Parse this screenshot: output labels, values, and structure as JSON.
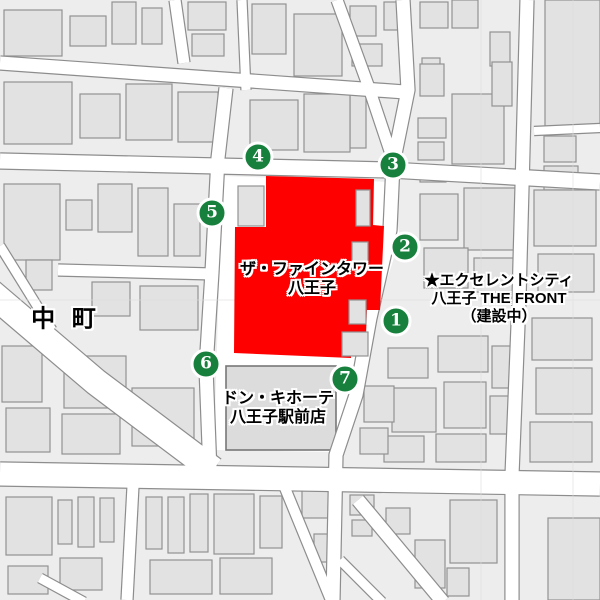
{
  "map": {
    "colors": {
      "background": "#ffffff",
      "block_base": "#ededed",
      "building_fill": "#e2e2e2",
      "building_stroke": "#929292",
      "road_fill": "#ffffff",
      "road_casing": "#8d8d8d",
      "courtyard": "#ffffff",
      "highlight_red": "#ff0000",
      "marker_green": "#17803d",
      "marker_ring": "#ffffff",
      "label_text": "#000000",
      "label_halo": "#ffffff",
      "grid_line": "#dddddd",
      "major_building_fill": "#dcdcdc",
      "major_building_stroke": "#777777"
    },
    "roads": [
      {
        "id": "h-top",
        "pts": [
          [
            0,
            63
          ],
          [
            405,
            92
          ]
        ],
        "w": 13
      },
      {
        "id": "h-mid",
        "pts": [
          [
            0,
            161
          ],
          [
            390,
            170
          ],
          [
            600,
            182
          ]
        ],
        "w": 15
      },
      {
        "id": "h-bottom",
        "pts": [
          [
            0,
            474
          ],
          [
            600,
            484
          ]
        ],
        "w": 23
      },
      {
        "id": "v-left-top",
        "pts": [
          [
            175,
            0
          ],
          [
            184,
            63
          ]
        ],
        "w": 11
      },
      {
        "id": "v-left",
        "pts": [
          [
            226,
            88
          ],
          [
            218,
            158
          ],
          [
            212,
            272
          ],
          [
            206,
            368
          ],
          [
            210,
            472
          ]
        ],
        "w": 13
      },
      {
        "id": "v-mid-top",
        "pts": [
          [
            242,
            0
          ],
          [
            246,
            90
          ]
        ],
        "w": 9
      },
      {
        "id": "diag-topmid",
        "pts": [
          [
            337,
            0
          ],
          [
            368,
            85
          ],
          [
            394,
            163
          ]
        ],
        "w": 11
      },
      {
        "id": "v-right",
        "pts": [
          [
            403,
            0
          ],
          [
            408,
            90
          ],
          [
            393,
            164
          ],
          [
            390,
            230
          ],
          [
            370,
            318
          ],
          [
            356,
            395
          ],
          [
            336,
            455
          ],
          [
            333,
            600
          ]
        ],
        "w": 13
      },
      {
        "id": "v-farright",
        "pts": [
          [
            527,
            0
          ],
          [
            519,
            300
          ],
          [
            512,
            475
          ],
          [
            512,
            600
          ]
        ],
        "w": 13
      },
      {
        "id": "h-nakacho-upper",
        "pts": [
          [
            58,
            270
          ],
          [
            213,
            274
          ]
        ],
        "w": 11
      },
      {
        "id": "diag-nakacho",
        "pts": [
          [
            -12,
            290
          ],
          [
            96,
            382
          ],
          [
            213,
            470
          ]
        ],
        "w": 26
      },
      {
        "id": "diag-nakacho-branch",
        "pts": [
          [
            0,
            246
          ],
          [
            52,
            330
          ]
        ],
        "w": 9
      },
      {
        "id": "v-bottom-130",
        "pts": [
          [
            133,
            486
          ],
          [
            127,
            600
          ]
        ],
        "w": 11
      },
      {
        "id": "diag-bottom-1",
        "pts": [
          [
            285,
            488
          ],
          [
            335,
            610
          ]
        ],
        "w": 10
      },
      {
        "id": "diag-bottom-2",
        "pts": [
          [
            358,
            500
          ],
          [
            443,
            602
          ]
        ],
        "w": 13
      },
      {
        "id": "diag-bottom-3",
        "pts": [
          [
            340,
            560
          ],
          [
            382,
            602
          ]
        ],
        "w": 9
      },
      {
        "id": "diag-bottom-left",
        "pts": [
          [
            40,
            578
          ],
          [
            84,
            602
          ]
        ],
        "w": 9
      },
      {
        "id": "h-farright-gap",
        "pts": [
          [
            534,
            131
          ],
          [
            600,
            128
          ]
        ],
        "w": 8
      }
    ],
    "buildings": [
      [
        4,
        10,
        58,
        46
      ],
      [
        70,
        16,
        36,
        30
      ],
      [
        112,
        2,
        24,
        42
      ],
      [
        142,
        8,
        20,
        36
      ],
      [
        188,
        2,
        38,
        28
      ],
      [
        192,
        34,
        32,
        22
      ],
      [
        252,
        4,
        34,
        50
      ],
      [
        294,
        14,
        48,
        62
      ],
      [
        350,
        6,
        26,
        30
      ],
      [
        384,
        2,
        16,
        28
      ],
      [
        352,
        44,
        30,
        22
      ],
      [
        350,
        92,
        16,
        56
      ],
      [
        420,
        2,
        28,
        26
      ],
      [
        452,
        0,
        26,
        28
      ],
      [
        490,
        32,
        20,
        34
      ],
      [
        422,
        58,
        18,
        14
      ],
      [
        545,
        0,
        55,
        128
      ],
      [
        544,
        136,
        32,
        26
      ],
      [
        544,
        166,
        34,
        24
      ],
      [
        420,
        64,
        24,
        32
      ],
      [
        452,
        94,
        52,
        70
      ],
      [
        418,
        118,
        28,
        20
      ],
      [
        418,
        142,
        26,
        18
      ],
      [
        492,
        62,
        20,
        44
      ],
      [
        420,
        166,
        26,
        16
      ],
      [
        4,
        82,
        68,
        62
      ],
      [
        80,
        94,
        40,
        44
      ],
      [
        126,
        84,
        46,
        56
      ],
      [
        178,
        92,
        40,
        50
      ],
      [
        250,
        100,
        48,
        50
      ],
      [
        304,
        94,
        46,
        58
      ],
      [
        4,
        184,
        56,
        76
      ],
      [
        66,
        200,
        26,
        30
      ],
      [
        98,
        184,
        34,
        48
      ],
      [
        138,
        188,
        30,
        68
      ],
      [
        174,
        204,
        26,
        52
      ],
      [
        420,
        194,
        38,
        46
      ],
      [
        464,
        188,
        52,
        62
      ],
      [
        424,
        248,
        44,
        40
      ],
      [
        474,
        258,
        40,
        34
      ],
      [
        534,
        190,
        62,
        56
      ],
      [
        538,
        254,
        56,
        38
      ],
      [
        92,
        282,
        38,
        34
      ],
      [
        140,
        286,
        58,
        44
      ],
      [
        26,
        260,
        26,
        30
      ],
      [
        64,
        356,
        62,
        52
      ],
      [
        132,
        388,
        62,
        58
      ],
      [
        62,
        414,
        58,
        40
      ],
      [
        2,
        346,
        40,
        56
      ],
      [
        6,
        408,
        44,
        44
      ],
      [
        388,
        348,
        40,
        30
      ],
      [
        392,
        388,
        44,
        44
      ],
      [
        384,
        436,
        40,
        26
      ],
      [
        438,
        336,
        50,
        36
      ],
      [
        444,
        382,
        42,
        46
      ],
      [
        492,
        346,
        26,
        42
      ],
      [
        490,
        396,
        28,
        38
      ],
      [
        436,
        434,
        50,
        28
      ],
      [
        532,
        318,
        60,
        42
      ],
      [
        536,
        368,
        56,
        46
      ],
      [
        530,
        422,
        62,
        40
      ],
      [
        364,
        386,
        30,
        36
      ],
      [
        360,
        428,
        28,
        26
      ],
      [
        238,
        186,
        26,
        40
      ],
      [
        6,
        497,
        46,
        58
      ],
      [
        58,
        500,
        14,
        44
      ],
      [
        78,
        497,
        16,
        50
      ],
      [
        100,
        498,
        14,
        44
      ],
      [
        8,
        566,
        40,
        28
      ],
      [
        60,
        558,
        42,
        32
      ],
      [
        146,
        497,
        16,
        52
      ],
      [
        168,
        497,
        16,
        56
      ],
      [
        190,
        494,
        18,
        58
      ],
      [
        214,
        494,
        40,
        60
      ],
      [
        260,
        496,
        22,
        52
      ],
      [
        150,
        560,
        62,
        34
      ],
      [
        220,
        558,
        52,
        36
      ],
      [
        302,
        490,
        28,
        28
      ],
      [
        314,
        534,
        18,
        28
      ],
      [
        350,
        495,
        24,
        20
      ],
      [
        352,
        520,
        20,
        16
      ],
      [
        386,
        508,
        24,
        26
      ],
      [
        415,
        540,
        30,
        48
      ],
      [
        450,
        500,
        47,
        63
      ],
      [
        447,
        568,
        22,
        28
      ],
      [
        548,
        518,
        52,
        82
      ]
    ],
    "courtyard": [
      [
        222,
        176
      ],
      [
        392,
        182
      ],
      [
        400,
        240
      ],
      [
        374,
        318
      ],
      [
        350,
        404
      ],
      [
        336,
        452
      ],
      [
        214,
        450
      ]
    ],
    "red_building": [
      [
        266,
        176
      ],
      [
        374,
        179
      ],
      [
        373,
        225
      ],
      [
        384,
        226
      ],
      [
        380,
        310
      ],
      [
        367,
        310
      ],
      [
        366,
        335
      ],
      [
        352,
        336
      ],
      [
        351,
        358
      ],
      [
        234,
        353
      ],
      [
        235,
        227
      ],
      [
        266,
        227
      ]
    ],
    "red_accents": [
      [
        356,
        190,
        14,
        36
      ],
      [
        352,
        242,
        16,
        22
      ],
      [
        349,
        300,
        17,
        24
      ],
      [
        342,
        332,
        26,
        24
      ]
    ],
    "don_building": [
      226,
      366,
      110,
      84
    ],
    "grid": {
      "vertical": [
        481,
        573
      ],
      "horizontal": [
        300
      ]
    }
  },
  "markers": [
    {
      "number": "1",
      "x": 396,
      "y": 321
    },
    {
      "number": "2",
      "x": 405,
      "y": 247
    },
    {
      "number": "3",
      "x": 393,
      "y": 165
    },
    {
      "number": "4",
      "x": 258,
      "y": 157
    },
    {
      "number": "5",
      "x": 212,
      "y": 213
    },
    {
      "number": "6",
      "x": 206,
      "y": 364
    },
    {
      "number": "7",
      "x": 345,
      "y": 379
    }
  ],
  "labels": {
    "highlight_building": {
      "lines": [
        "ザ・ファインタワー",
        "八王子"
      ],
      "x": 312,
      "y": 279
    },
    "district": {
      "text": "中 町",
      "x": 66,
      "y": 316
    },
    "excellent_city": {
      "lines": [
        "★エクセレントシティ",
        "八王子 THE FRONT",
        "（建設中）"
      ],
      "x": 499,
      "y": 299
    },
    "don_quijote": {
      "lines": [
        "ドン・キホーテ",
        "八王子駅前店"
      ],
      "x": 278,
      "y": 408
    }
  }
}
